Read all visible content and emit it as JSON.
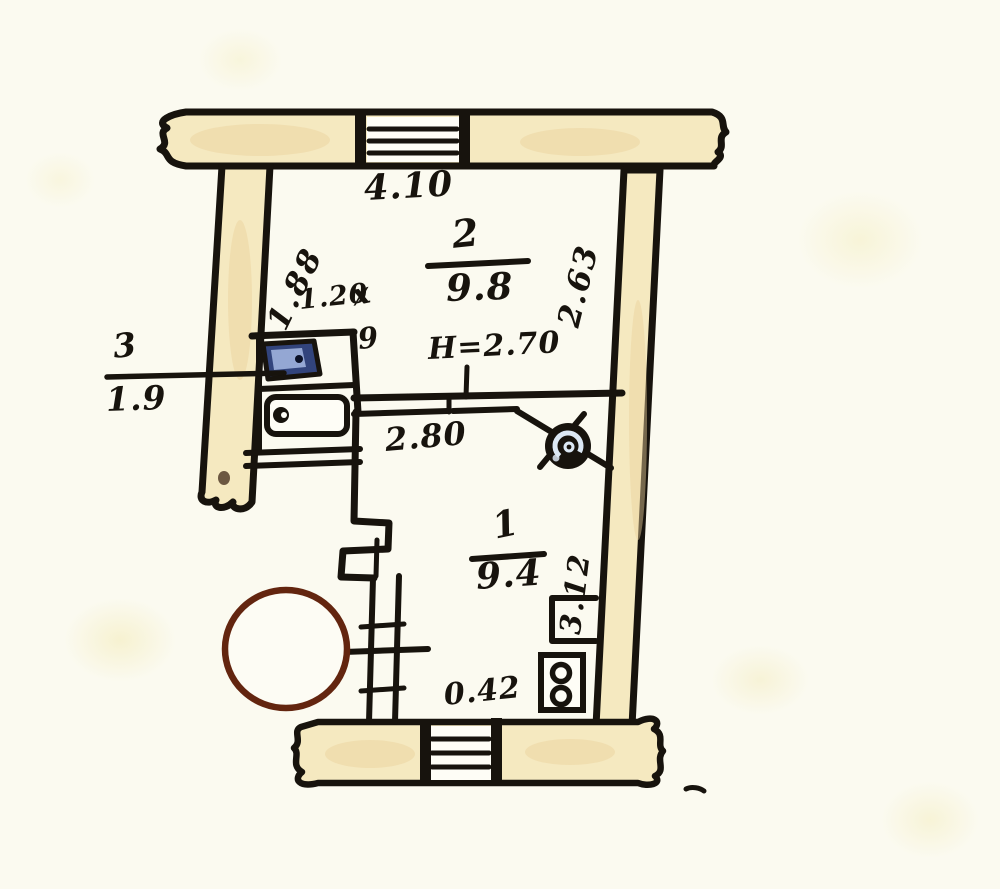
{
  "plan": {
    "type": "apartment-floor-plan-scan",
    "rooms": {
      "room1": {
        "number": "1",
        "area": "9.4",
        "side_depth": "3.12",
        "corner_dim": "0.42"
      },
      "room2": {
        "number": "2",
        "area": "9.8",
        "top_width": "4.10",
        "left_depth": "1.88",
        "right_depth": "2.63",
        "inner_width": "2.80",
        "height_note": "H=2.70"
      },
      "room3": {
        "number": "3",
        "area": "1.9"
      }
    },
    "niche": {
      "width": "1.20",
      "mark": "х",
      "depth": "9"
    }
  },
  "symbols": {
    "vent_fan": "ventilation-fan",
    "sink": "kitchen-sink",
    "stove": "stove-with-handle",
    "outlet": "double-burner-outlet",
    "stamp": "round-stamp-circle",
    "window": "wall-window-hatch"
  },
  "colors": {
    "paper": "#fbfaf0",
    "ink": "#17130d",
    "wall_fill": "#f5e9c0",
    "window_white": "#fefdf6",
    "sink_blue": "#32447c",
    "sink_blue_light": "#9fb2dd",
    "fan_highlight": "#dce8f4",
    "stamp_red": "#63250f"
  }
}
